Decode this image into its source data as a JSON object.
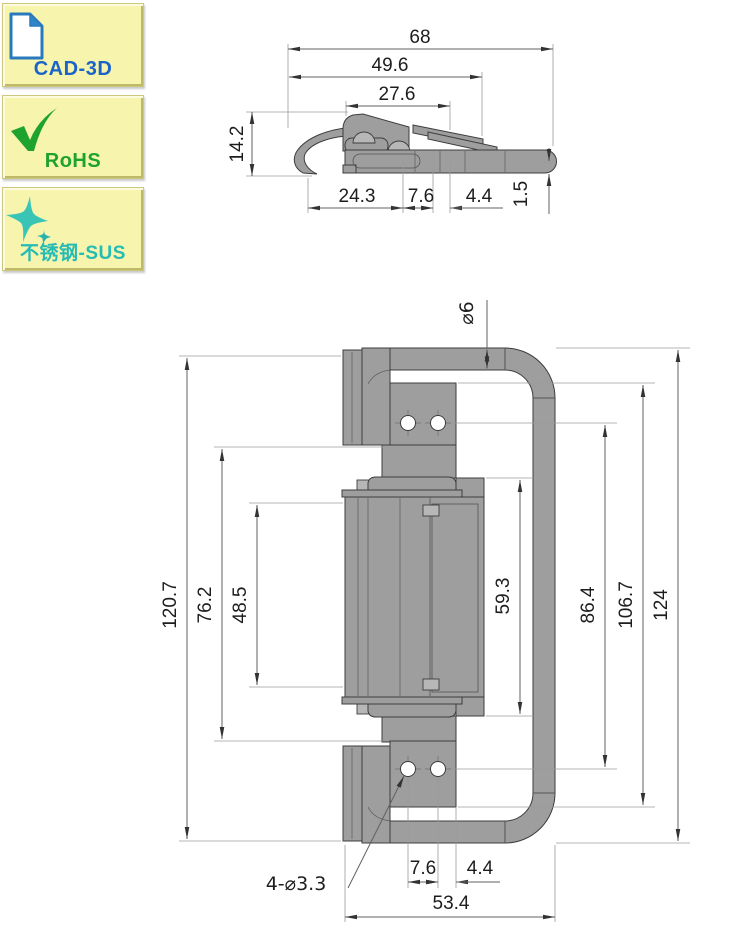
{
  "badges": [
    {
      "label": "CAD-3D",
      "icon": "cad-3d-document-icon",
      "text_color": "#1a63c8"
    },
    {
      "label": "RoHS",
      "icon": "rohs-check-icon",
      "text_color": "#1da32e"
    },
    {
      "label": "不锈钢-SUS",
      "icon": "sus-sparkle-icon",
      "text_color": "#26bcb4"
    }
  ],
  "drawing": {
    "kind": "2-view dimensioned CAD drawing of a spring draw latch with handle loop",
    "top_view": {
      "dims": {
        "d68": "68",
        "d49_6": "49.6",
        "d27_6": "27.6",
        "d14_2": "14.2",
        "d24_3": "24.3",
        "d7_6": "7.6",
        "d4_4": "4.4",
        "d1_5": "1.5"
      }
    },
    "front_view": {
      "dims": {
        "dia6": "⌀6",
        "d120_7": "120.7",
        "d76_2": "76.2",
        "d48_5": "48.5",
        "d59_3": "59.3",
        "d86_4": "86.4",
        "d106_7": "106.7",
        "d124": "124",
        "d7_6": "7.6",
        "d4_4": "4.4",
        "d53_4": "53.4",
        "hole_callout": "4-⌀3.3"
      }
    },
    "colors": {
      "part_fill": "#9e9e9e",
      "part_light": "#b7b7b7",
      "outline": "#3d3d3d",
      "dim_line": "#606060",
      "badge_bg": "#f7f4ae"
    }
  }
}
